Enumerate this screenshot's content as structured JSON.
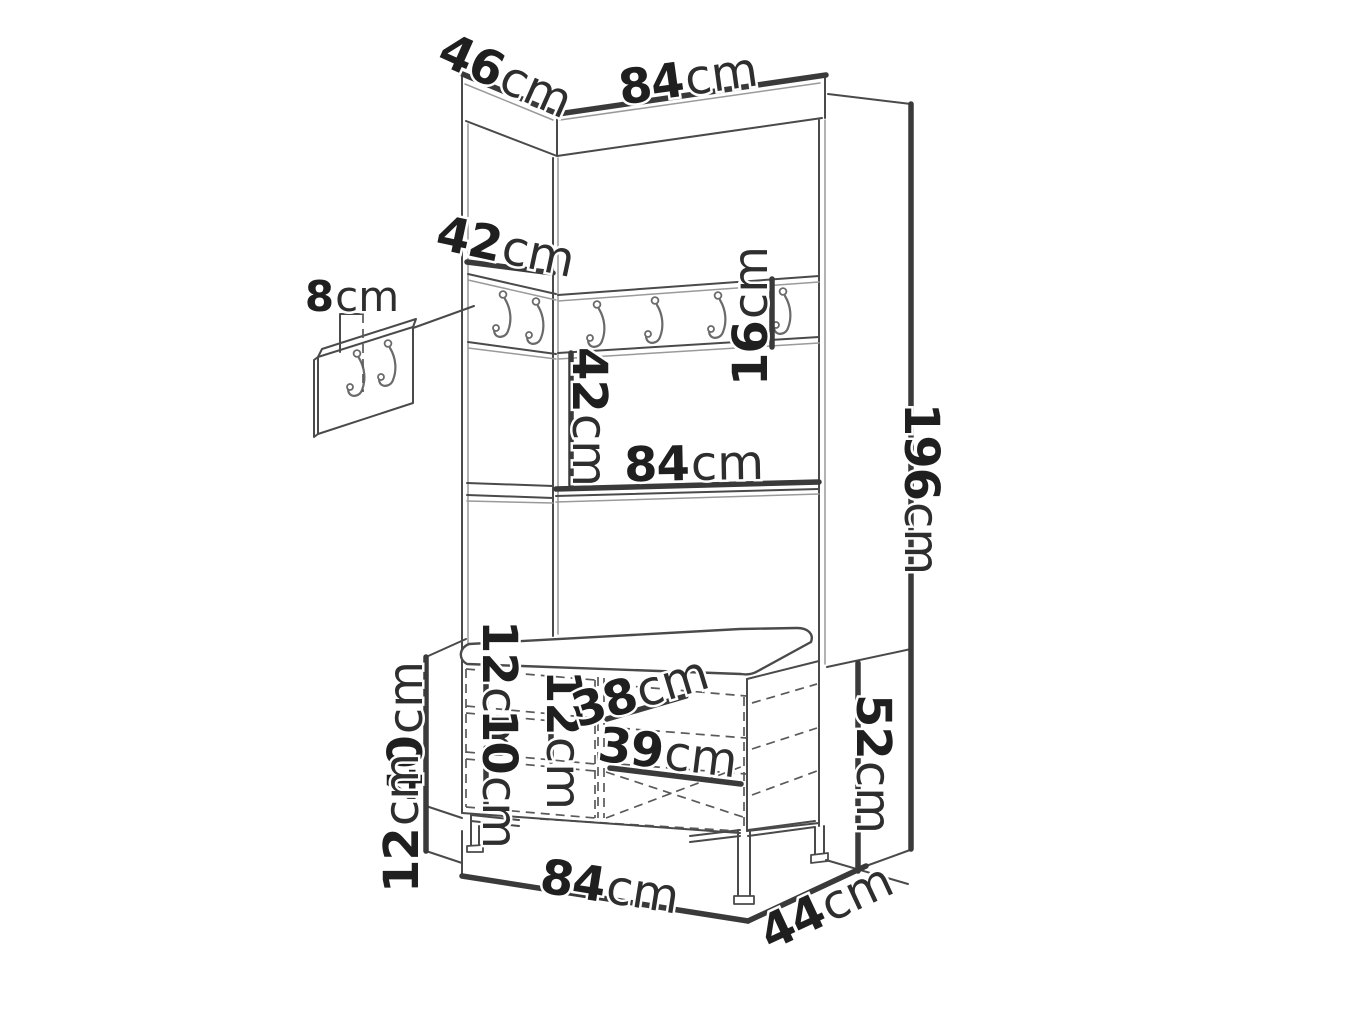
{
  "diagram": {
    "type": "furniture-dimension-drawing",
    "subject": "hallway corner wardrobe with coat hooks, shelf and shoe bench",
    "background": "#ffffff",
    "line_color": "#4a4a4a",
    "dimension_line_color": "#3a3a3a",
    "text_color": "#1f1f1f",
    "unit": "cm",
    "main_rail_hooks": 6,
    "detail_panel_hooks": 2
  },
  "dims": {
    "top_depth": {
      "value": "46",
      "unit": "cm"
    },
    "top_width": {
      "value": "84",
      "unit": "cm"
    },
    "rail_side": {
      "value": "42",
      "unit": "cm"
    },
    "rail_height": {
      "value": "16",
      "unit": "cm"
    },
    "hook_spacing": {
      "value": "8",
      "unit": "cm"
    },
    "rail_to_shelf": {
      "value": "42",
      "unit": "cm"
    },
    "shelf_width": {
      "value": "84",
      "unit": "cm"
    },
    "total_height": {
      "value": "196",
      "unit": "cm"
    },
    "bench_top_gap": {
      "value": "12",
      "unit": "cm"
    },
    "bench_mid_gap": {
      "value": "12",
      "unit": "cm"
    },
    "bench_low_gap": {
      "value": "10",
      "unit": "cm"
    },
    "bench_depth_upper": {
      "value": "38",
      "unit": "cm"
    },
    "bench_depth_lower": {
      "value": "39",
      "unit": "cm"
    },
    "bench_body_height": {
      "value": "40",
      "unit": "cm"
    },
    "bench_leg_height": {
      "value": "12",
      "unit": "cm"
    },
    "bench_total_height": {
      "value": "52",
      "unit": "cm"
    },
    "bench_width": {
      "value": "84",
      "unit": "cm"
    },
    "bench_depth": {
      "value": "44",
      "unit": "cm"
    }
  }
}
